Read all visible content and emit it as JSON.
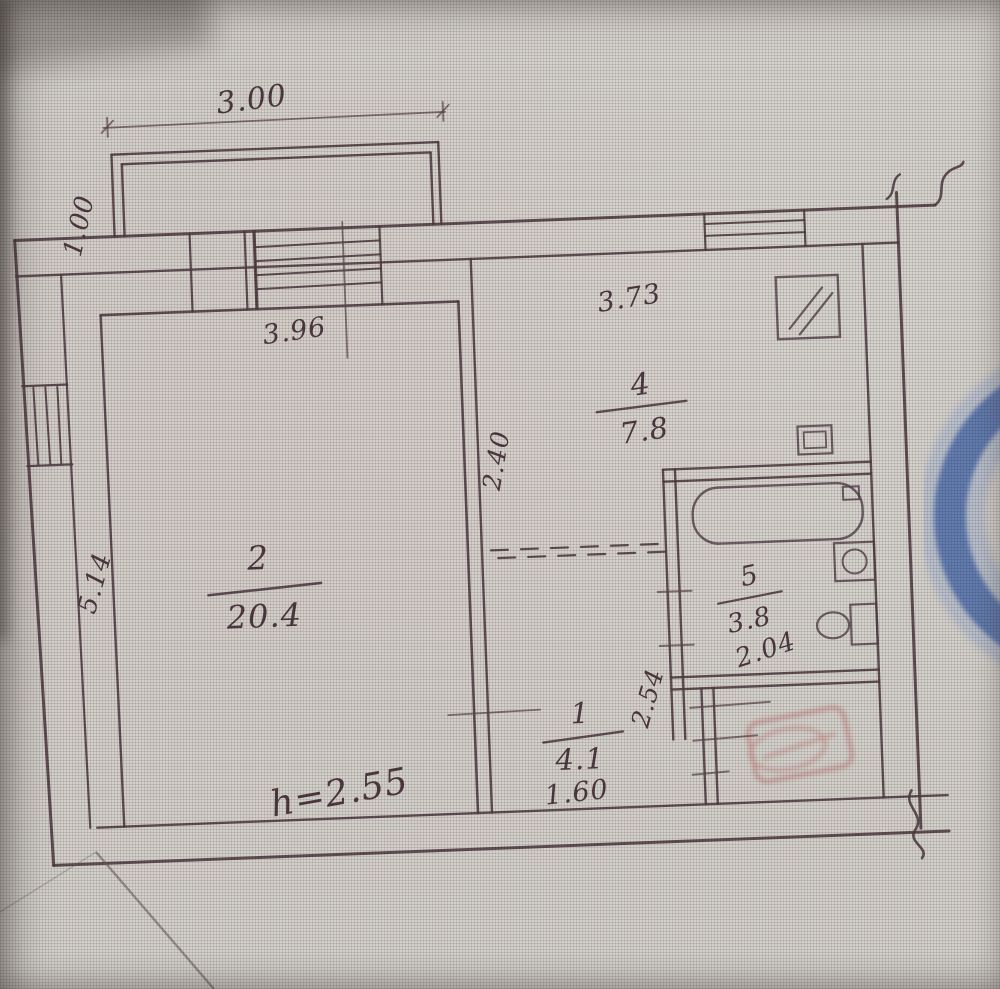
{
  "meta": {
    "kind": "hand-drawn apartment floor plan (technical passport sheet, photographed)",
    "colors": {
      "paper": "#d3d0ca",
      "pencil_ink": "#503b42",
      "stamp_blue": "#4a69a8",
      "stamp_red": "#b84a4a"
    }
  },
  "plan": {
    "balcony": {
      "width_dim": "3.00",
      "depth_dim": "1.00"
    },
    "room2": {
      "number": "2",
      "area": "20.4",
      "width_dim": "3.96",
      "length_dim": "5.14"
    },
    "kitchen": {
      "number": "4",
      "area": "7.8",
      "width_dim": "3.73",
      "depth_dim": "2.40"
    },
    "bathroom": {
      "number": "5",
      "area": "3.8",
      "width_dim": "2.04"
    },
    "hallway": {
      "number": "1",
      "area": "4.1",
      "width_dim": "1.60",
      "depth_dim": "2.54"
    },
    "ceiling_height_note": "h=2.55"
  }
}
